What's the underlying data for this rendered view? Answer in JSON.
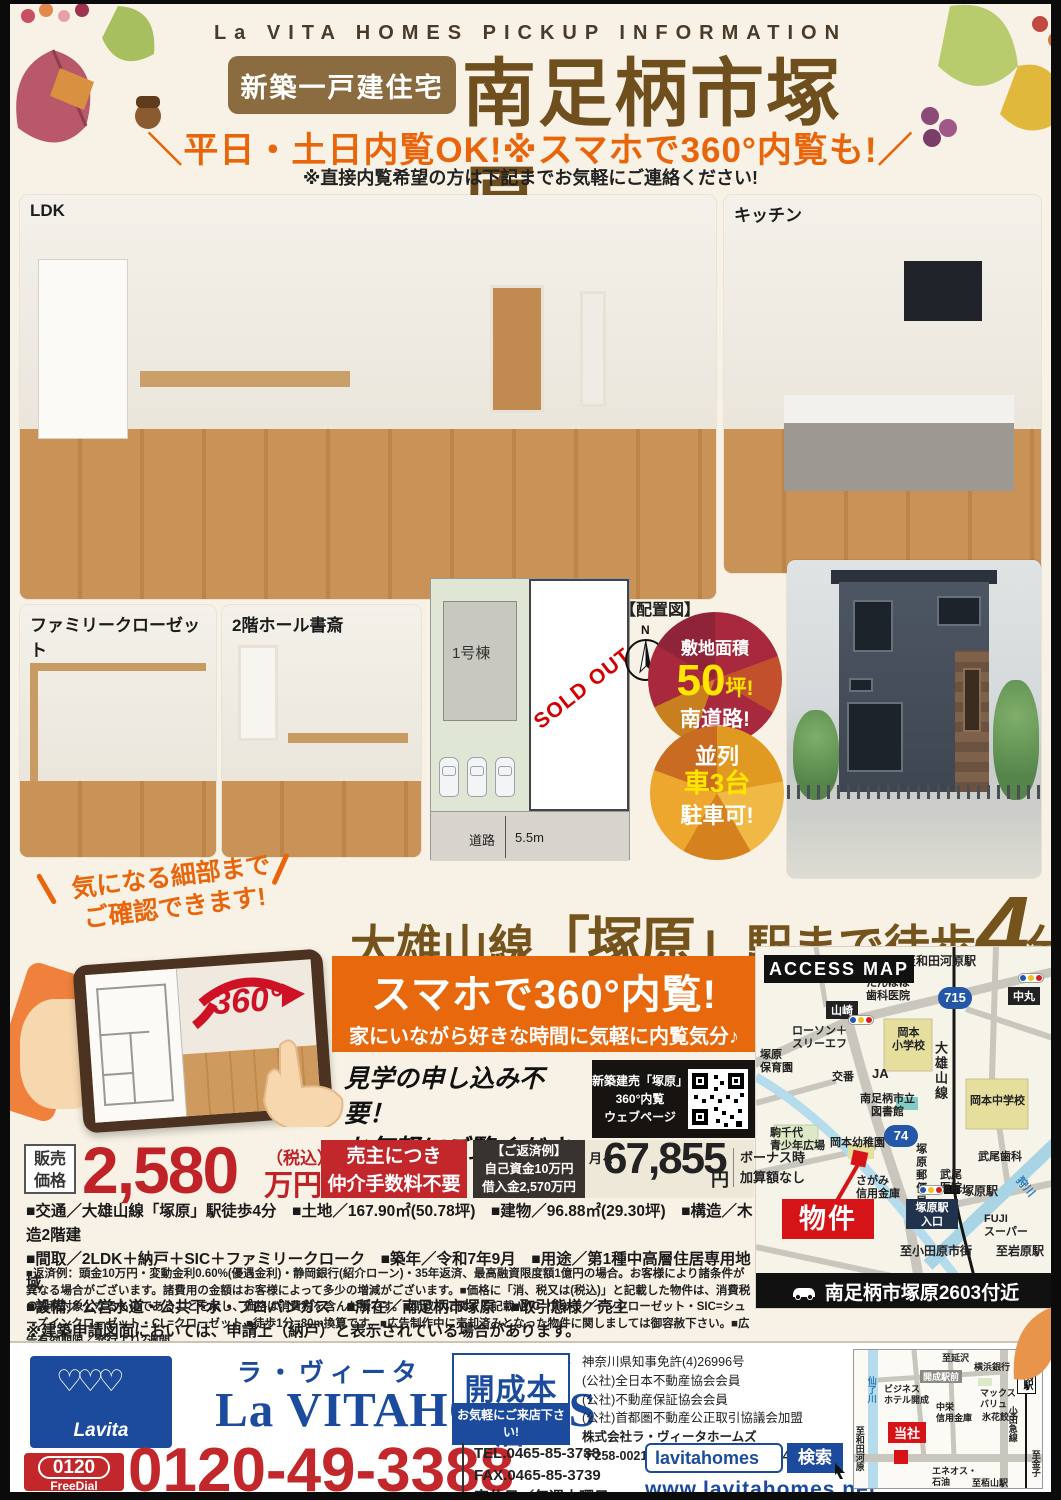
{
  "header": {
    "kicker": "La VITA HOMES PICKUP INFORMATION",
    "badge": "新築一戸建住宅",
    "title": "南足柄市塚原",
    "slogan": "＼平日・土日内覧OK!※スマホで360°内覧も!／",
    "note": "※直接内覧希望の方は下記までお気軽にご連絡ください!"
  },
  "photos": {
    "ldk_label": "LDK",
    "kitchen_label": "キッチン",
    "closet_label": "ファミリークローゼット",
    "study_label": "2階ホール書斎"
  },
  "site_plan": {
    "caption": "【配置図】",
    "north": "N",
    "building": "1号棟",
    "sold_out": "SOLD OUT",
    "road": "道路",
    "road_width": "5.5m"
  },
  "badges": {
    "area": {
      "line1": "敷地面積",
      "num": "50",
      "unit": "坪!",
      "line3": "南道路!"
    },
    "parking": {
      "line1": "並列",
      "line2": "車3台",
      "line3": "駐車可!"
    }
  },
  "bubble": "気になる細部まで\nご確認できます!",
  "tablet": {
    "badge_360": "360°"
  },
  "station_headline": {
    "pre": "大雄山線",
    "station": "「塚原」",
    "mid": "駅まで徒歩",
    "num": "4",
    "suffix": "分"
  },
  "promo360": {
    "title": "スマホで360°内覧!",
    "subtitle": "家にいながら好きな時間に気軽に内覧気分♪",
    "cta": "見学の申し込み不要！\nお気軽にご覧ください！",
    "qr_label": "新築建売「塚原」\n360°内覧\nウェブページ"
  },
  "price": {
    "label": "販売\n価格",
    "amount": "2,580",
    "tax_note": "（税込）",
    "unit": "万円",
    "no_fee": "売主につき\n仲介手数料不要",
    "repay": "【ご返済例】\n自己資金10万円\n借入金2,570万円",
    "monthly_prefix": "月々",
    "monthly_amount": "67,855",
    "monthly_unit": "円",
    "bonus": "ボーナス時\n加算額なし"
  },
  "details": {
    "line1": "■交通／大雄山線「塚原」駅徒歩4分　■土地／167.90㎡(50.78坪)　■建物／96.88㎡(29.30坪)　■構造／木造2階建",
    "line2": "■間取／2LDK＋納戸＋SIC＋ファミリークローク　■築年／令和7年9月　■用途／第1種中高層住居専用地域",
    "line3": "■設備／公営水道・公共下水・プロパンガス　■所在／南足柄市塚原　■取引態様／売主",
    "line4": "※建築申請図面においては、申請上（納戸）と表示されている場合があります。"
  },
  "fine_print": "■返済例：頭金10万円・変動金利0.60%(優遇金利)・静岡銀行(紹介ローン)・35年返済、最高融資限度額1億円の場合。お客様により諸条件が異なる場合がございます。諸費用の金額はお客様によって多少の増減がございます。■価格に「消、税又は(税込)」と記載した物件は、消費税の課税対象となるものであることを示し、価格は消費税を含んだ額です。■間取りに関する記載:WIC=ウォークインクローゼット・SIC=シューズインクローゼット・CL=クローゼット ■徒歩1分=80m換算です。■広告制作中に売却済みとなった物件に関しましては御容赦下さい。■広告有効期限／発行より2週間",
  "access_map": {
    "title": "ACCESS MAP",
    "route_715": "715",
    "route_74": "74",
    "labels": [
      "至和田河原駅",
      "たんぽぽ\n歯科医院",
      "中丸",
      "山崎",
      "ローソン＋\nスリーエフ",
      "塚原\n保育園",
      "交番",
      "岡本\n小学校",
      "JA",
      "大雄山線",
      "南足柄市立\n図書館",
      "岡本中学校",
      "駒千代\n青少年広場",
      "岡本幼稚園",
      "塚原郵便局",
      "さがみ\n信用金庫",
      "武尾\n医院",
      "武尾歯科",
      "塚原駅",
      "塚原駅\n入口",
      "FUJI\nスーパー",
      "狩川",
      "物件",
      "至小田原市街",
      "至岩原駅"
    ],
    "address_bar": "南足柄市塚原2603付近"
  },
  "footer": {
    "logo_text": "Lavita",
    "brand_kana": "ラ・ヴィータ　ホームズ",
    "brand_en": "La VITAHOMES",
    "shop": "開成本店",
    "shop_sub": "お気軽にご来店下さい!",
    "legal_lines": "神奈川県知事免許(4)26996号\n(公社)全日本不動産協会会員\n(公社)不動産保証協会会員\n(公社)首都圏不動産公正取引協議会加盟",
    "company": "株式会社ラ・ヴィータホームズ",
    "address": "〒258-0021 足柄上郡開成町吉田島4458-3",
    "freedial_num": "0120",
    "freedial_label": "FreeDial",
    "phone": "0120-49-3388",
    "contact": "TEL.0465-85-3738\nFAX.0465-85-3739\n定休日／毎週水曜日",
    "search_text": "lavitahomes",
    "search_button": "検索",
    "url": "www.lavitahomes.net",
    "map_labels": [
      "仙了川",
      "至延沢",
      "横浜銀行",
      "開成駅前",
      "ビジネス\nホテル開成",
      "マックス\nバリュ",
      "中栄\n信用金庫",
      "氷花餃子",
      "開成駅",
      "小田急線",
      "当社",
      "エネオス・\n石油",
      "至栢山駅",
      "至和田河原",
      "至金子"
    ]
  }
}
